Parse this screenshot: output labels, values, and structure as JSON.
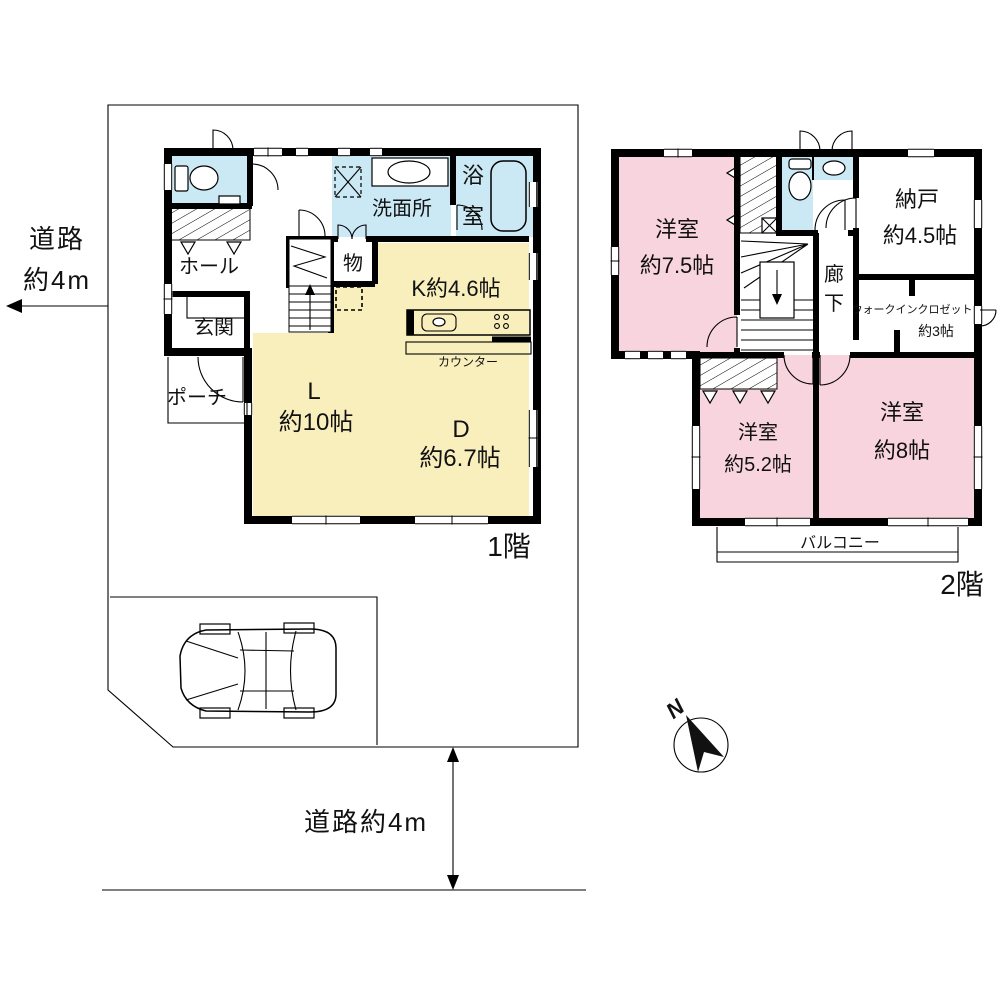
{
  "site": {
    "road_left_line1": "道路",
    "road_left_line2": "約4m",
    "road_bottom": "道路約4m",
    "compass_north": "N"
  },
  "floor1": {
    "floor_label": "1階",
    "hall": "ホール",
    "entrance": "玄関",
    "porch": "ポーチ",
    "storage": "物",
    "washroom": "洗面所",
    "bath_char1": "浴",
    "bath_char2": "室",
    "kitchen": "K約4.6帖",
    "living_line1": "L",
    "living_line2": "約10帖",
    "dining_line1": "D",
    "dining_line2": "約6.7帖",
    "counter": "カウンター"
  },
  "floor2": {
    "floor_label": "2階",
    "bedroom1_line1": "洋室",
    "bedroom1_line2": "約7.5帖",
    "corridor_char1": "廊",
    "corridor_char2": "下",
    "storeroom_line1": "納戸",
    "storeroom_line2": "約4.5帖",
    "wic_line1": "ウォークインクロゼット",
    "wic_line2": "約3帖",
    "bedroom2_line1": "洋室",
    "bedroom2_line2": "約5.2帖",
    "bedroom3_line1": "洋室",
    "bedroom3_line2": "約8帖",
    "balcony": "バルコニー"
  },
  "colors": {
    "wet_area": "#cbe9f5",
    "ldk": "#f9efbd",
    "bedroom": "#f8d4de",
    "wall": "#000000"
  }
}
